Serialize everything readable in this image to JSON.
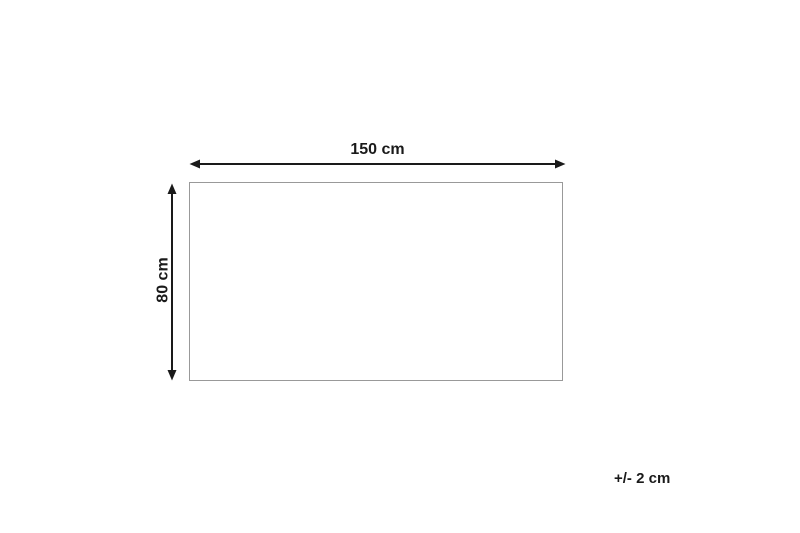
{
  "figure": {
    "type": "dimension-diagram",
    "shape": "rectangle",
    "width_label": "150 cm",
    "height_label": "80 cm",
    "tolerance_label": "+/- 2 cm",
    "width_cm": 150,
    "height_cm": 80,
    "tolerance_cm": 2
  },
  "colors": {
    "background": "#ffffff",
    "line": "#1a1a1a",
    "text": "#1a1a1a",
    "shapeBorder": "#999999",
    "shapeFill": "#ffffff"
  }
}
